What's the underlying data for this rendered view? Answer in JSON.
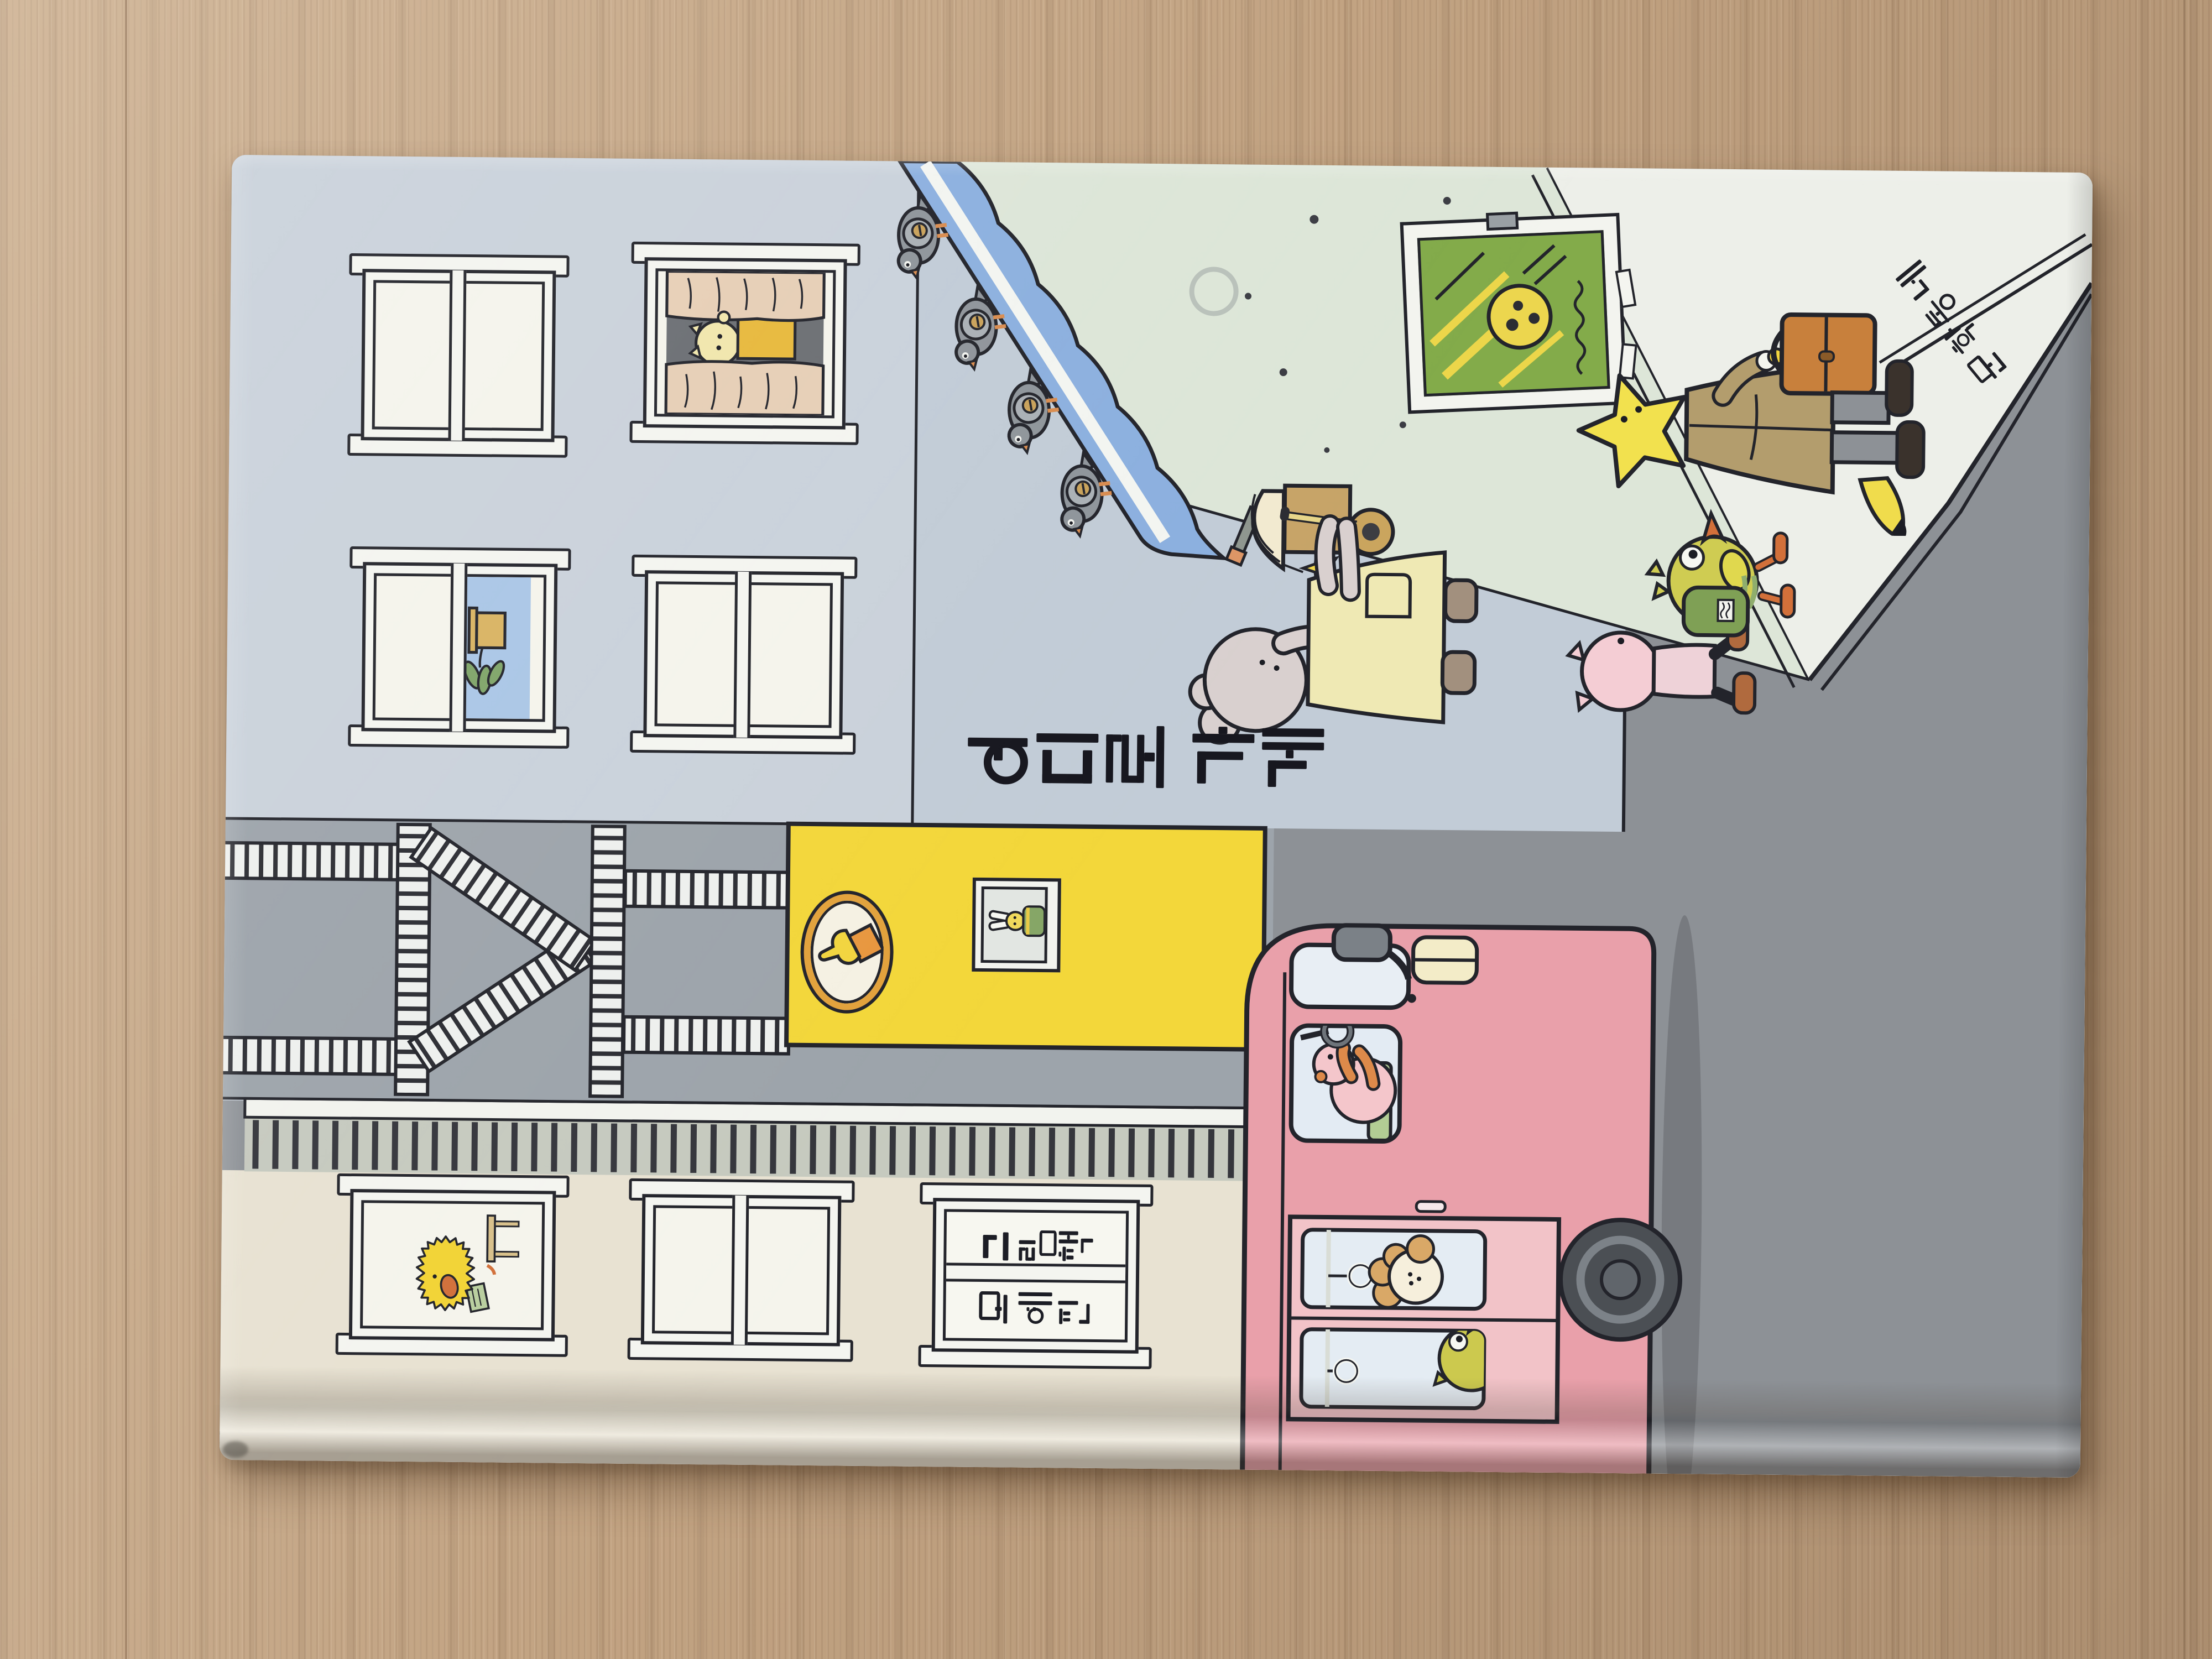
{
  "book_cover": {
    "title": "어디로 가게",
    "credits_window": {
      "left_pane": "모예진",
      "right_pane": "그림책"
    },
    "publisher": "문학동네"
  },
  "theme": {
    "ink": "#23242b",
    "wood": "#c2a382",
    "cover_cream": "#e8e2d2",
    "facade_grey": "#cad2db",
    "light_wall": "#c2ccd7",
    "fire_escape_grey": "#9da4ab",
    "shop_yellow": "#f3d73a",
    "awning_blue": "#8cb0df",
    "wall_green": "#dde6d8",
    "street_grey": "#8d9196",
    "sidewalk": "#edefe9",
    "bus_pink": "#e9a0aa",
    "bus_door_pink": "#f2c3c8",
    "briefcase_brown": "#c8803c",
    "star_yellow": "#f2e14e"
  }
}
